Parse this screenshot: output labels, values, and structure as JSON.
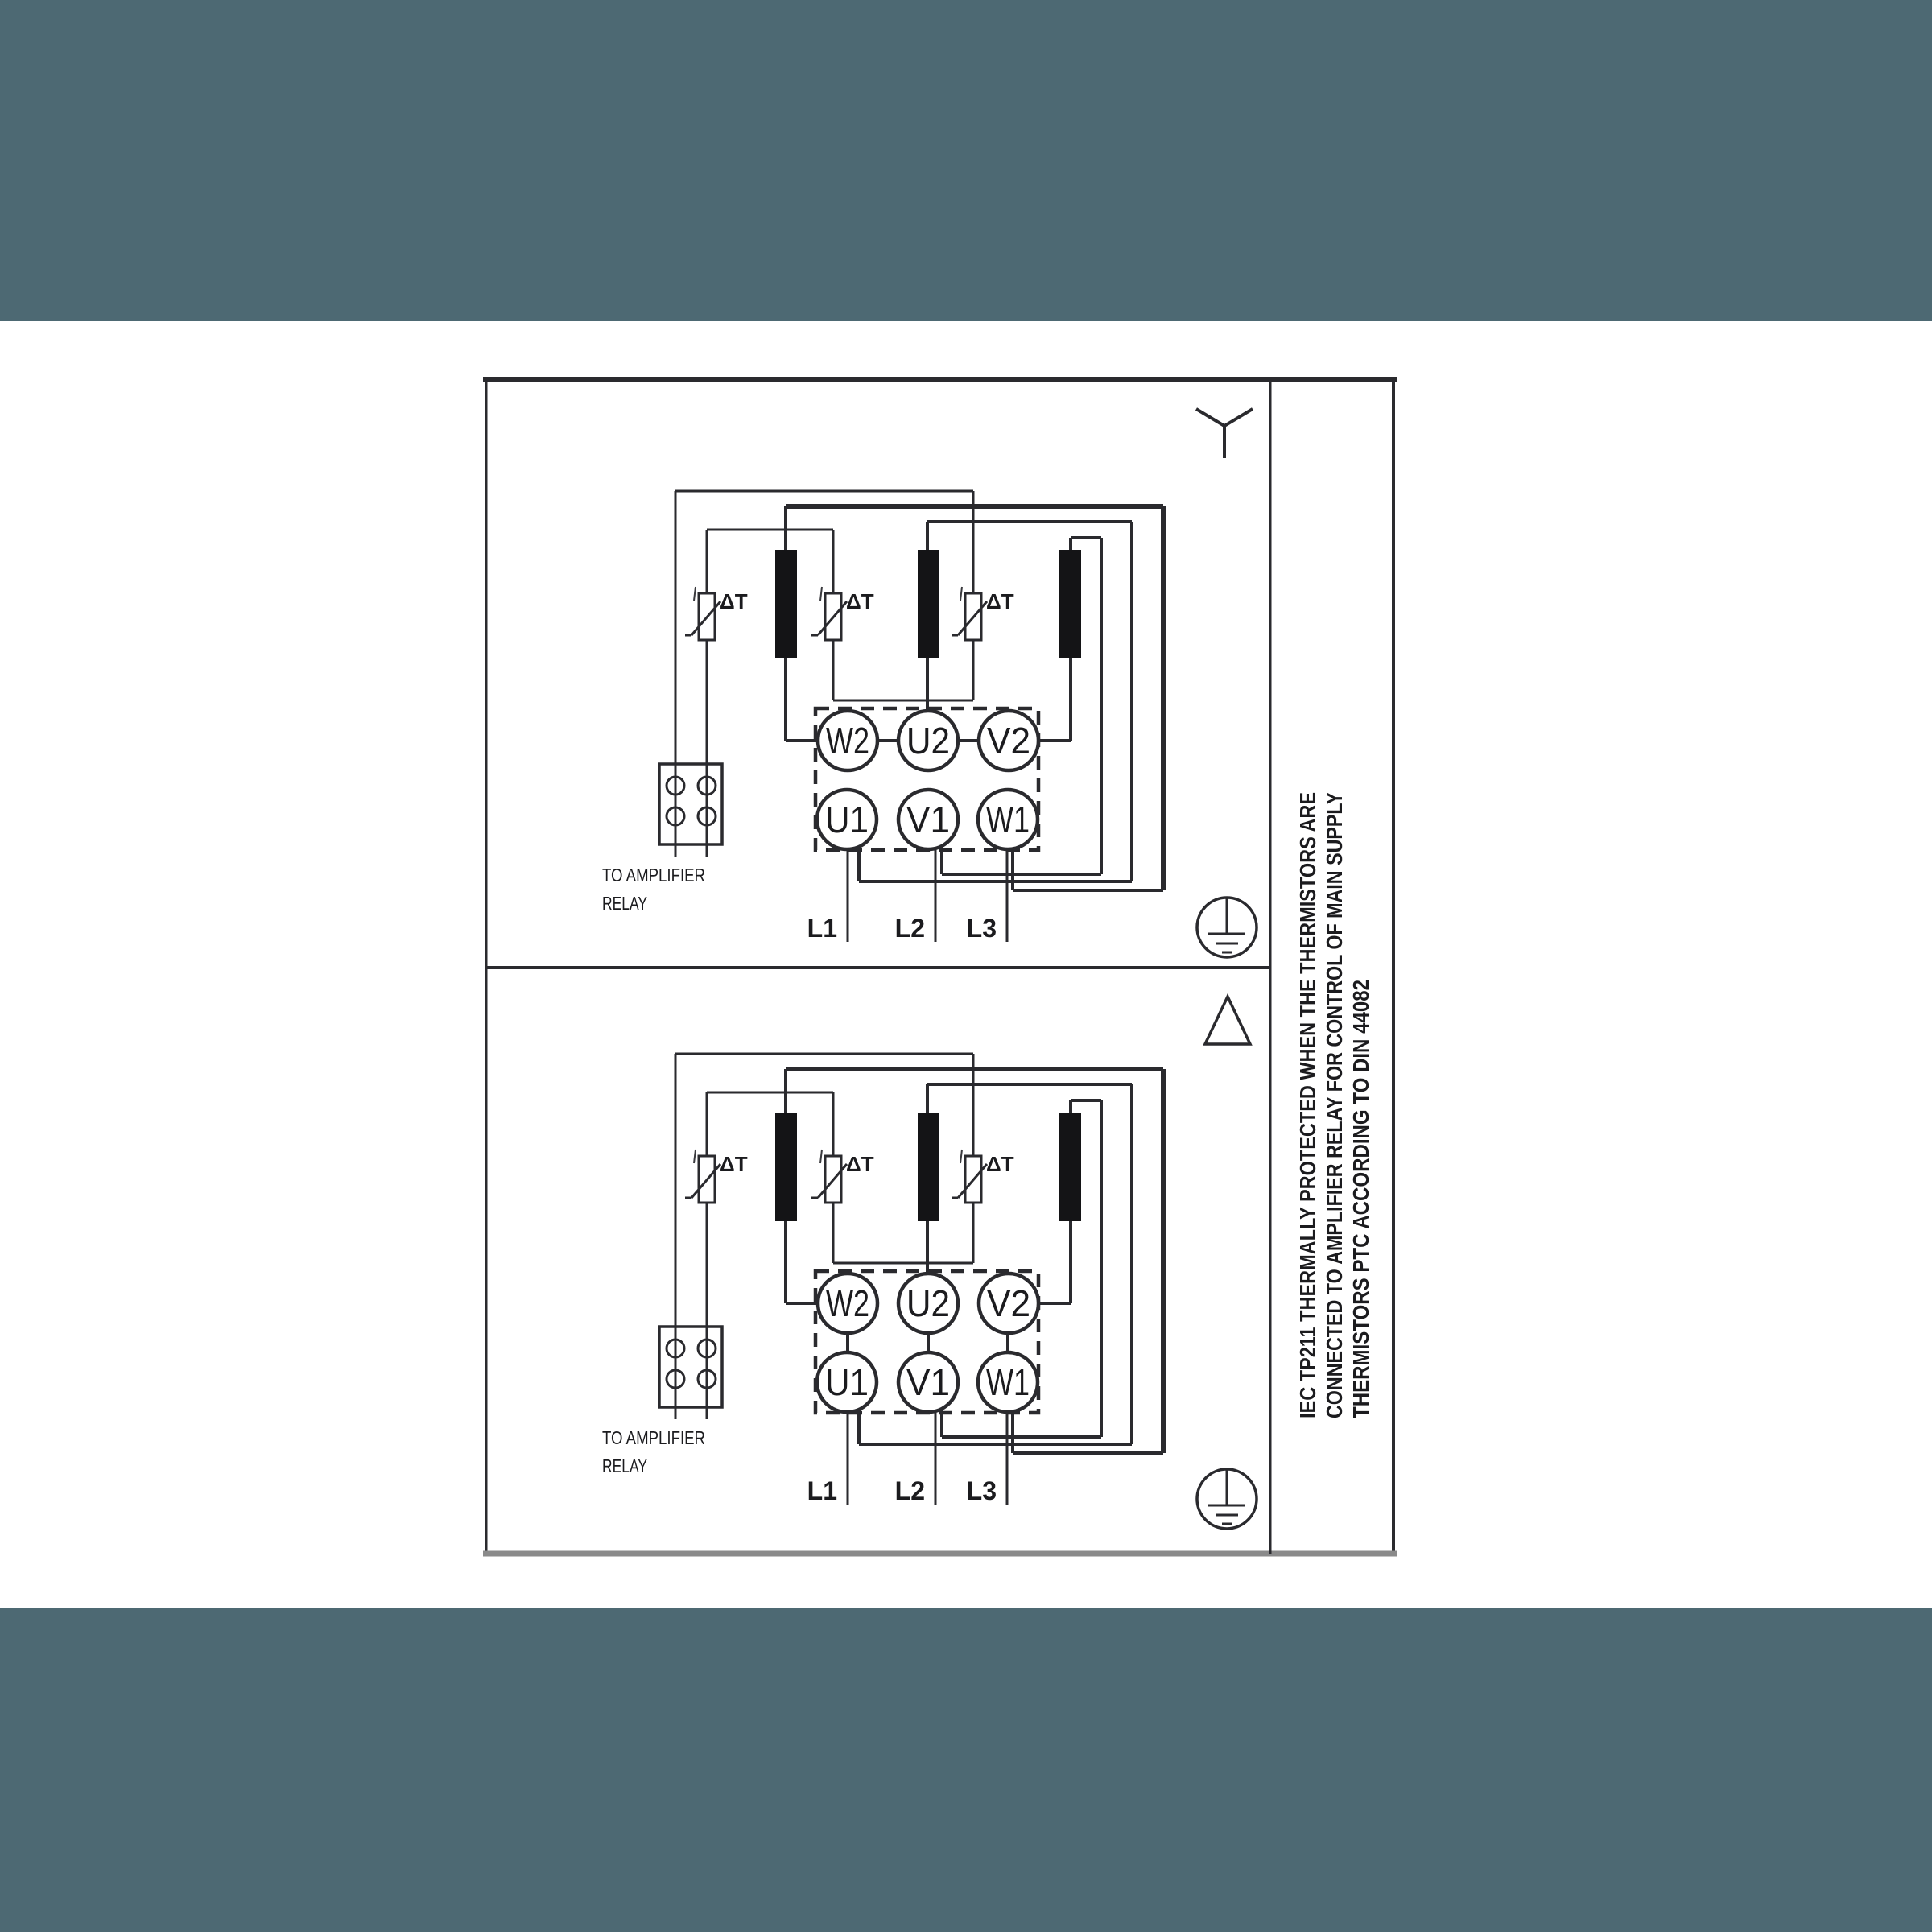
{
  "colors": {
    "band": "#4d6973",
    "ink": "#2a2a2e",
    "thin_ink": "#3a3a3e",
    "bar_fill": "#141416",
    "bottom_border": "#8a8a8a",
    "paper": "#ffffff"
  },
  "note": {
    "line1": "IEC TP211 THERMALLY PROTECTED WHEN THE THERMISTORS ARE",
    "line2": "CONNECTED TO AMPLIFIER RELAY FOR CONTROL OF MAIN SUPPLY",
    "line3": "THERMISTORS PTC ACCORDING TO DIN 44082"
  },
  "sections": [
    {
      "name": "star",
      "connection_symbol": "star",
      "terminals_top": [
        "W2",
        "U2",
        "V2"
      ],
      "terminals_bottom": [
        "U1",
        "V1",
        "W1"
      ],
      "supply_lines": [
        "L1",
        "L2",
        "L3"
      ],
      "relay_note": [
        "TO AMPLIFIER",
        "RELAY"
      ],
      "thermistor_label": "ΔT"
    },
    {
      "name": "delta",
      "connection_symbol": "delta",
      "terminals_top": [
        "W2",
        "U2",
        "V2"
      ],
      "terminals_bottom": [
        "U1",
        "V1",
        "W1"
      ],
      "supply_lines": [
        "L1",
        "L2",
        "L3"
      ],
      "relay_note": [
        "TO AMPLIFIER",
        "RELAY"
      ],
      "thermistor_label": "ΔT"
    }
  ]
}
